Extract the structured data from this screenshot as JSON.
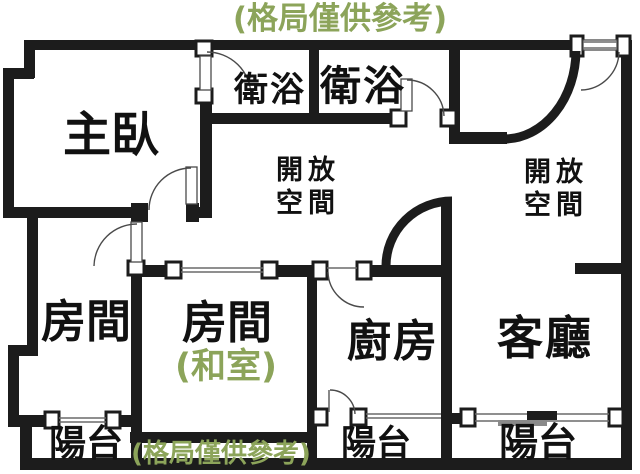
{
  "plan": {
    "note_top": "(格局僅供參考)",
    "note_bottom": "(格局僅供參考)",
    "rooms": {
      "master_bedroom": "主臥",
      "bathroom_1": "衛浴",
      "bathroom_2": "衛浴",
      "open_space_left_line1": "開放",
      "open_space_left_line2": "空間",
      "open_space_right_line1": "開放",
      "open_space_right_line2": "空間",
      "room_left": "房間",
      "room_tatami": "房間",
      "room_tatami_sub": "(和室)",
      "kitchen": "廚房",
      "living_room": "客廳",
      "balcony_left": "陽台",
      "balcony_middle": "陽台",
      "balcony_right": "陽台"
    },
    "colors": {
      "wall": "#1c1c1c",
      "note_green": "#8ca45a",
      "label_text": "#111111",
      "background": "#ffffff"
    }
  }
}
